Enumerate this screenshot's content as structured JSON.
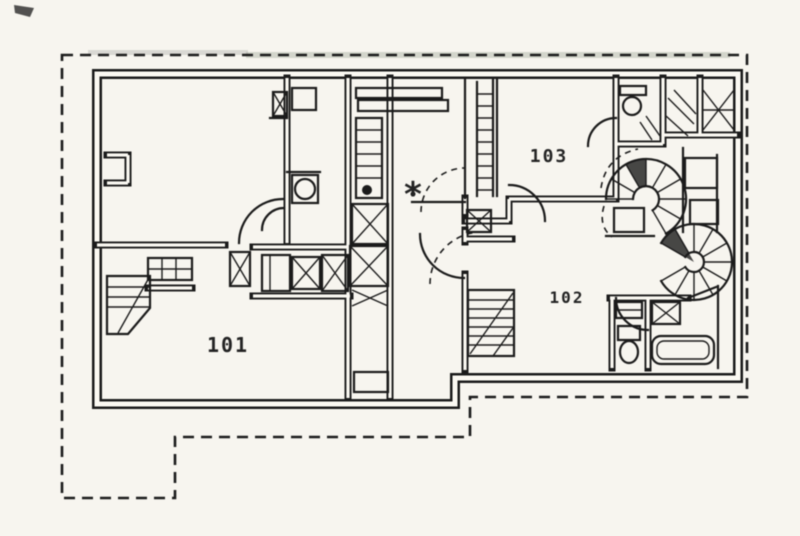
{
  "document": {
    "kind": "Scanned architectural floor plan",
    "background_color": "#f7f5ef",
    "ink_color": "#1e1e1e"
  },
  "labels": {
    "unit_101": "101",
    "unit_102": "102",
    "unit_103": "103",
    "center_marker": "*"
  }
}
